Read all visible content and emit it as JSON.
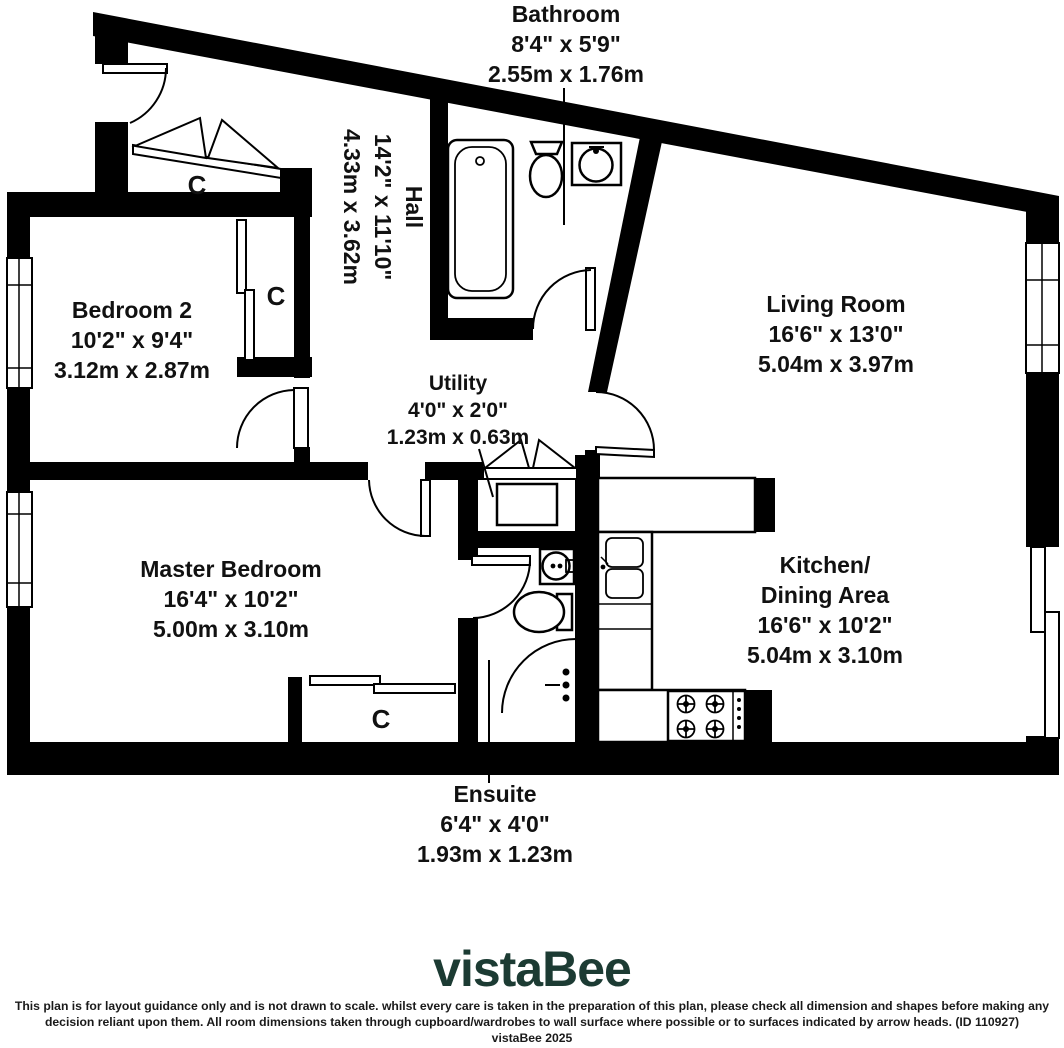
{
  "plan": {
    "rooms": [
      {
        "name": "Bathroom",
        "imperial": "8'4\" x 5'9\"",
        "metric": "2.55m x 1.76m"
      },
      {
        "name": "Hall",
        "imperial": "14'2\" x 11'10\"",
        "metric": "4.33m x 3.62m"
      },
      {
        "name": "Bedroom 2",
        "imperial": "10'2\" x 9'4\"",
        "metric": "3.12m x 2.87m"
      },
      {
        "name": "Living Room",
        "imperial": "16'6\" x 13'0\"",
        "metric": "5.04m x 3.97m"
      },
      {
        "name": "Utility",
        "imperial": "4'0\" x 2'0\"",
        "metric": "1.23m x 0.63m"
      },
      {
        "name": "Master Bedroom",
        "imperial": "16'4\" x 10'2\"",
        "metric": "5.00m x 3.10m"
      },
      {
        "name": "Kitchen/",
        "name_line2": "Dining Area",
        "imperial": "16'6\" x 10'2\"",
        "metric": "5.04m x 3.10m"
      },
      {
        "name": "Ensuite",
        "imperial": "6'4\" x 4'0\"",
        "metric": "1.93m x 1.23m"
      }
    ],
    "closet_label": "C",
    "colors": {
      "walls": "#000000",
      "label_text": "#111111"
    }
  },
  "branding": {
    "logo_text": "vistaBee",
    "logo_color": "#1c3b33"
  },
  "footer": {
    "disclaimer_line1": "This plan is for layout guidance only and is not drawn to scale. whilst every care is taken in the preparation of this plan, please check all dimension and shapes before making any",
    "disclaimer_line2": "decision reliant upon them. All room dimensions taken through cupboard/wardrobes to wall surface where possible or to surfaces indicated by arrow heads. (ID 110927)",
    "disclaimer_line3": "vistaBee 2025"
  }
}
